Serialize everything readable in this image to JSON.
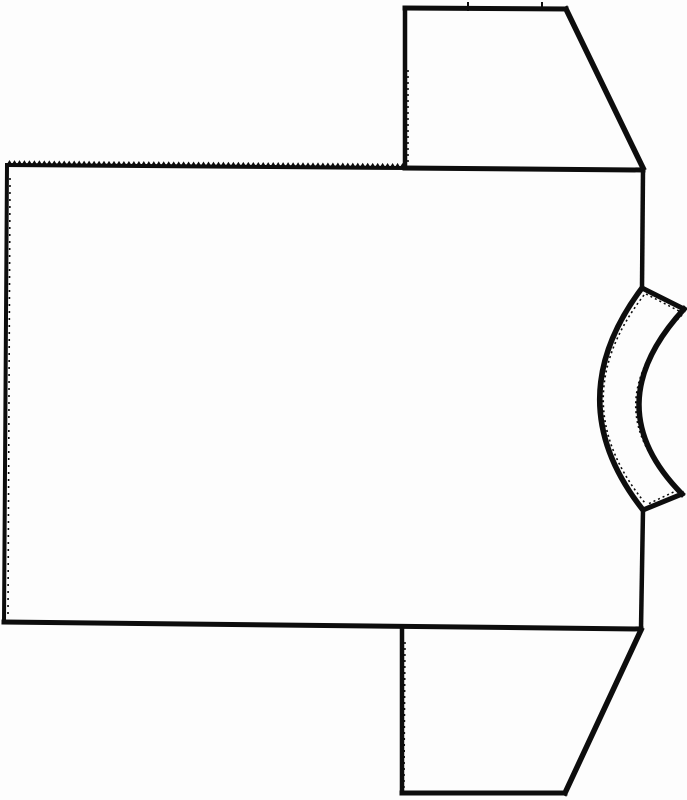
{
  "canvas": {
    "width": 687,
    "height": 800,
    "background": "#fdfdfd"
  },
  "drawing": {
    "stroke_color": "#0d0d0d",
    "shapes": [
      {
        "name": "body-left-edge",
        "type": "line",
        "x1": 7,
        "y1": 165,
        "x2": 4,
        "y2": 622,
        "w": 4
      },
      {
        "name": "body-left-edge-fuzz",
        "type": "line",
        "x1": 10,
        "y1": 178,
        "x2": 8,
        "y2": 614,
        "w": 1.6,
        "dash": "2 5"
      },
      {
        "name": "body-bottom-edge",
        "type": "line",
        "x1": 4,
        "y1": 622,
        "x2": 641,
        "y2": 629,
        "w": 5
      },
      {
        "name": "body-shoulder-zigzag-edge",
        "type": "zigzag",
        "x1": 7,
        "y1": 165,
        "x2": 405,
        "y2": 168,
        "teeth": 80,
        "amp": 4,
        "base_w": 4
      },
      {
        "name": "body-top-edge",
        "type": "line",
        "x1": 405,
        "y1": 168,
        "x2": 643,
        "y2": 170,
        "w": 5
      },
      {
        "name": "body-right-edge-upper",
        "type": "line",
        "x1": 643,
        "y1": 170,
        "x2": 642,
        "y2": 288,
        "w": 4.5
      },
      {
        "name": "body-right-edge-lower",
        "type": "line",
        "x1": 643,
        "y1": 510,
        "x2": 641,
        "y2": 629,
        "w": 4.5
      },
      {
        "name": "sleeve-top-left-edge",
        "type": "line",
        "x1": 405,
        "y1": 8,
        "x2": 405,
        "y2": 168,
        "w": 4.5
      },
      {
        "name": "sleeve-top-left-edge-fuzz",
        "type": "line",
        "x1": 408,
        "y1": 70,
        "x2": 408,
        "y2": 164,
        "w": 1.5,
        "dash": "2 4"
      },
      {
        "name": "sleeve-top-top-edge",
        "type": "line",
        "x1": 405,
        "y1": 8,
        "x2": 566,
        "y2": 9,
        "w": 5
      },
      {
        "name": "sleeve-top-notch-1",
        "type": "line",
        "x1": 468,
        "y1": 3,
        "x2": 468,
        "y2": 10,
        "w": 2
      },
      {
        "name": "sleeve-top-notch-2",
        "type": "line",
        "x1": 542,
        "y1": 3,
        "x2": 542,
        "y2": 10,
        "w": 2
      },
      {
        "name": "sleeve-top-diagonal-edge",
        "type": "line",
        "x1": 566,
        "y1": 9,
        "x2": 643,
        "y2": 168,
        "w": 5.5
      },
      {
        "name": "sleeve-bottom-left-edge",
        "type": "line",
        "x1": 402,
        "y1": 630,
        "x2": 402,
        "y2": 793,
        "w": 4.5
      },
      {
        "name": "sleeve-bottom-left-edge-fuzz",
        "type": "line",
        "x1": 405,
        "y1": 642,
        "x2": 404,
        "y2": 788,
        "w": 1.5,
        "dash": "2 4"
      },
      {
        "name": "sleeve-bottom-bottom-edge",
        "type": "line",
        "x1": 402,
        "y1": 793,
        "x2": 565,
        "y2": 793,
        "w": 5
      },
      {
        "name": "sleeve-bottom-diagonal-edge",
        "type": "line",
        "x1": 565,
        "y1": 793,
        "x2": 641,
        "y2": 630,
        "w": 5.5
      },
      {
        "name": "neckband-top-edge",
        "type": "line",
        "x1": 642,
        "y1": 288,
        "x2": 684,
        "y2": 309,
        "w": 5
      },
      {
        "name": "neckband-outer-arc",
        "type": "path",
        "d": "M 642 288 Q 557 401 643 510",
        "w": 5.5
      },
      {
        "name": "neckband-inner-arc",
        "type": "path",
        "d": "M 684 309 Q 595 406 682 494",
        "w": 5.5
      },
      {
        "name": "neckband-bottom-edge",
        "type": "line",
        "x1": 682,
        "y1": 494,
        "x2": 643,
        "y2": 510,
        "w": 5
      },
      {
        "name": "neckband-outer-arc-fuzz",
        "type": "path",
        "d": "M 644 295 Q 562 401 645 503",
        "w": 1.6,
        "dash": "2 3"
      },
      {
        "name": "neckband-inner-arc-fuzz",
        "type": "path",
        "d": "M 682 315 Q 591 406 679 489",
        "w": 1.6,
        "dash": "2 3"
      },
      {
        "name": "neckband-top-edge-fuzz",
        "type": "line",
        "x1": 646,
        "y1": 294,
        "x2": 679,
        "y2": 311,
        "w": 1.5,
        "dash": "2 3"
      },
      {
        "name": "neckband-bottom-edge-fuzz",
        "type": "line",
        "x1": 678,
        "y1": 490,
        "x2": 648,
        "y2": 504,
        "w": 1.5,
        "dash": "2 3"
      }
    ]
  }
}
